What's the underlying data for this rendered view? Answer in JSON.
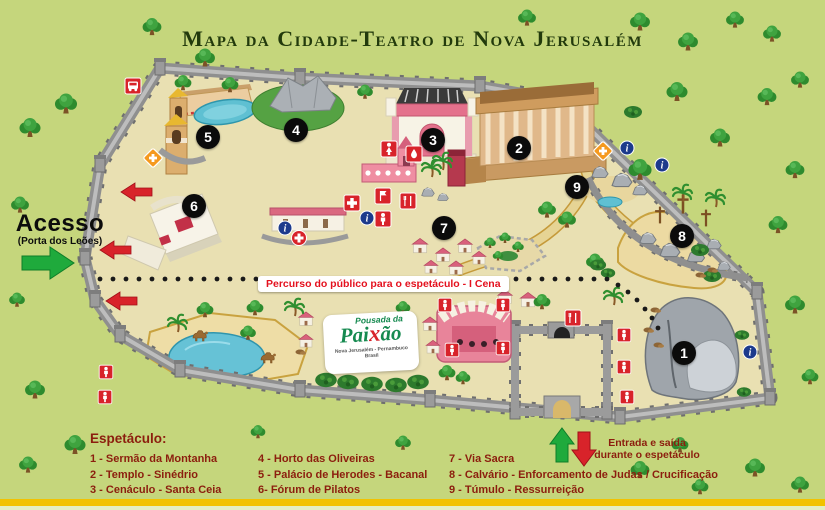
{
  "title": "Mapa da Cidade-Teatro de Nova Jerusalém",
  "access": {
    "label": "Acesso",
    "sublabel": "(Porta dos Leões)"
  },
  "route_banner": "Percurso do público para o espetáculo - I Cena",
  "pousada": {
    "top": "Pousada da",
    "main_pre": "Pai",
    "main_x": "x",
    "main_post": "ão",
    "sub": "Nova Jerusalém - Pernambuco",
    "sub2": "Brasil"
  },
  "entrance_note": {
    "line1": "Entrada e saída",
    "line2": "durante o espetáculo"
  },
  "legend": {
    "heading": "Espetáculo:",
    "columns": [
      [
        "1 - Sermão da Montanha",
        "2 - Templo - Sinédrio",
        "3 - Cenáculo - Santa Ceia"
      ],
      [
        "4 - Horto das Oliveiras",
        "5 - Palácio de Herodes - Bacanal",
        "6- Fórum de Pilatos"
      ],
      [
        "7 - Via Sacra",
        "8 - Calvário - Enforcamento de Judas / Crucificação",
        "9 - Túmulo - Ressurreição"
      ]
    ]
  },
  "markers": [
    {
      "n": "1"
    },
    {
      "n": "2"
    },
    {
      "n": "3"
    },
    {
      "n": "4"
    },
    {
      "n": "5"
    },
    {
      "n": "6"
    },
    {
      "n": "7"
    },
    {
      "n": "8"
    },
    {
      "n": "9"
    }
  ],
  "map_icons": {
    "bus-stop-icon": "bus stop",
    "assistance-icon": "first aid / assistance point (orange diamond with cross)",
    "restroom-women-icon": "women's restroom",
    "restroom-men-icon": "men's restroom",
    "drinking-water-icon": "drinking water",
    "food-icon": "food / restaurant",
    "first-aid-icon": "first aid post",
    "flag-icon": "flag point",
    "medical-icon": "medical point (red circle with cross)",
    "stand-icon": "audience stand marker (red square with person)",
    "info-icon": "information point (blue circle)",
    "access-arrow-icon": "public access arrow (green)",
    "exit-arrow-icon": "exit arrow (red)"
  },
  "colors": {
    "background": "#c5d67c",
    "city_ground": "#e9e0b2",
    "wall": "#8f8f8f",
    "accent_red": "#d8232a",
    "accent_green": "#1faa3c",
    "marker": "#0b0b0b",
    "legend_text": "#8c1e0e",
    "title": "#223a0c",
    "banner_text": "#e4111e",
    "lake": "#66c2d6",
    "bottom_bar": "#f2c200"
  }
}
